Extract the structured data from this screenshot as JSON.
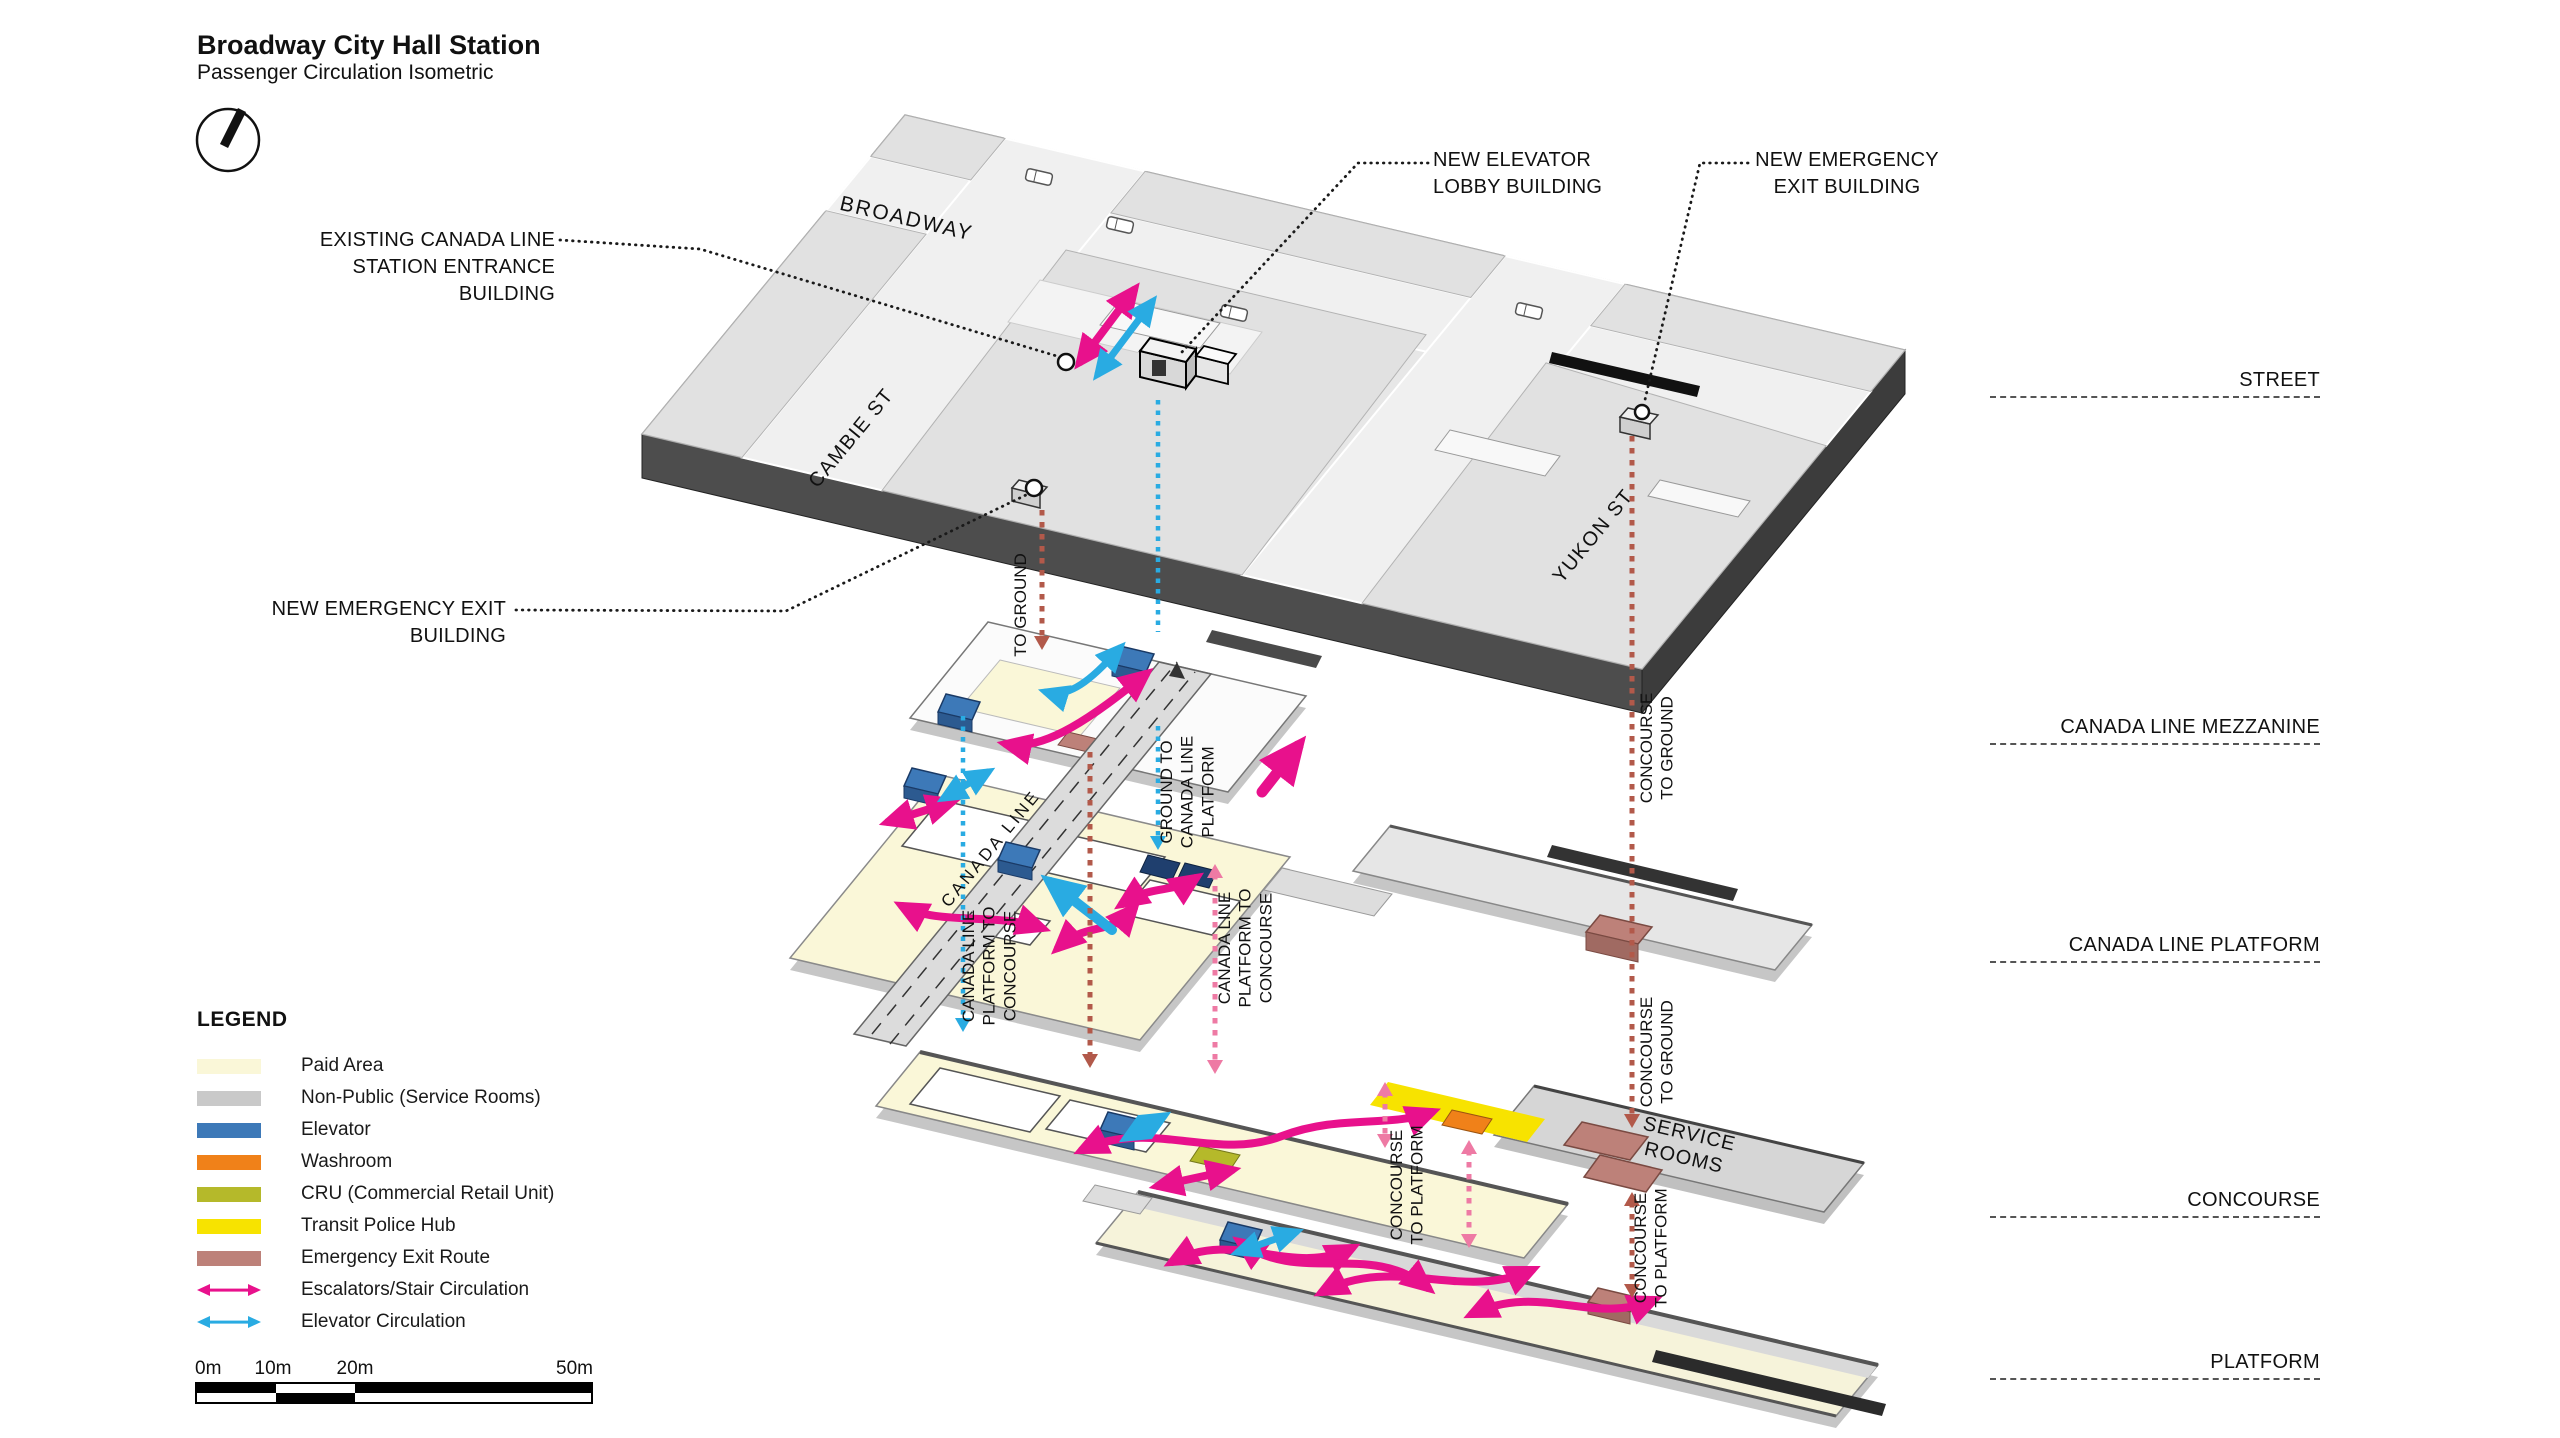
{
  "title": {
    "main": "Broadway City Hall Station",
    "sub": "Passenger Circulation Isometric"
  },
  "callouts": {
    "existing_entrance": "EXISTING CANADA LINE\nSTATION ENTRANCE\nBUILDING",
    "new_elevator_lobby": "NEW ELEVATOR\nLOBBY BUILDING",
    "new_emergency_exit_right": "NEW EMERGENCY\nEXIT BUILDING",
    "new_emergency_exit_left": "NEW EMERGENCY EXIT\nBUILDING"
  },
  "streets": {
    "broadway": "BROADWAY",
    "cambie": "CAMBIE ST",
    "yukon": "YUKON ST"
  },
  "levels": [
    "STREET",
    "CANADA LINE MEZZANINE",
    "CANADA LINE PLATFORM",
    "CONCOURSE",
    "PLATFORM"
  ],
  "flow_labels": {
    "to_ground": "TO GROUND",
    "concourse_to_ground": "CONCOURSE\nTO GROUND",
    "ground_to_clp": "GROUND TO\nCANADA LINE\nPLATFORM",
    "clp_to_concourse": "CANADA LINE\nPLATFORM TO\nCONCOURSE",
    "concourse_to_platform": "CONCOURSE\nTO PLATFORM",
    "canada_line": "CANADA LINE",
    "service_rooms": "SERVICE\nROOMS"
  },
  "legend": {
    "heading": "LEGEND",
    "items": [
      {
        "label": "Paid Area",
        "color": "#FAF7D8",
        "kind": "swatch"
      },
      {
        "label": "Non-Public (Service Rooms)",
        "color": "#C9C9C9",
        "kind": "swatch"
      },
      {
        "label": "Elevator",
        "color": "#3D79B8",
        "kind": "swatch"
      },
      {
        "label": "Washroom",
        "color": "#F08119",
        "kind": "swatch"
      },
      {
        "label": "CRU (Commercial Retail Unit)",
        "color": "#B5B92A",
        "kind": "swatch"
      },
      {
        "label": "Transit Police Hub",
        "color": "#F7E300",
        "kind": "swatch"
      },
      {
        "label": "Emergency Exit Route",
        "color": "#BD8179",
        "kind": "swatch"
      },
      {
        "label": "Escalators/Stair Circulation",
        "color": "#E8118C",
        "kind": "arrow"
      },
      {
        "label": "Elevator Circulation",
        "color": "#29ABE2",
        "kind": "arrow"
      }
    ]
  },
  "scale_bar": {
    "labels": [
      "0m",
      "10m",
      "20m",
      "50m"
    ]
  },
  "colors": {
    "escalator_circulation": "#E8118C",
    "elevator_circulation": "#29ABE2",
    "emergency_route_dots": "#B2594A",
    "transfer_dots_pink": "#EE7AA4",
    "paid_area": "#FAF7D8",
    "non_public": "#C9C9C9",
    "elevator": "#3D79B8",
    "washroom": "#F08119",
    "cru": "#B5B92A",
    "transit_police": "#F7E300",
    "emergency_exit": "#BD8179"
  }
}
